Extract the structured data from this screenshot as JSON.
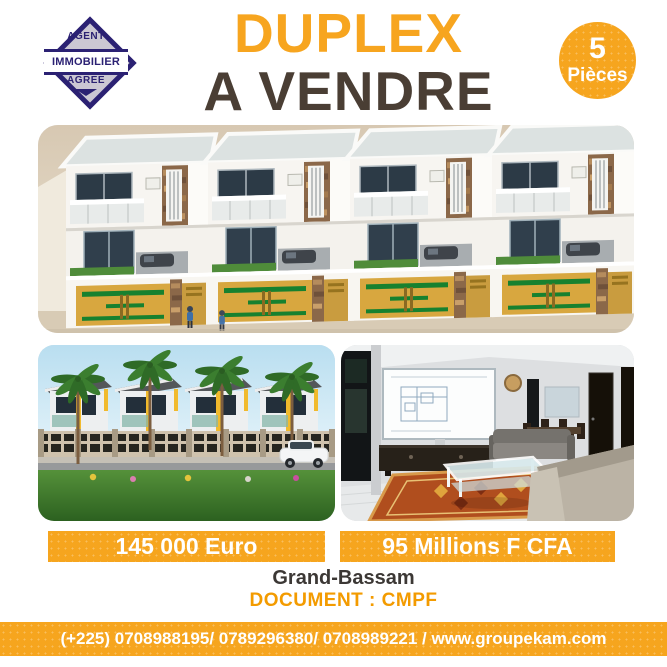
{
  "badge": {
    "top": "AGENT",
    "middle": "IMMOBILIER",
    "bottom": "AGREE"
  },
  "title": {
    "line1": "DUPLEX",
    "line2": "A VENDRE"
  },
  "rooms": {
    "count": "5",
    "label": "Pièces"
  },
  "images": {
    "main": "aerial-3d-render-four-attached-duplexes",
    "exterior": "street-view-render-duplex-row-palm-trees",
    "interior": "living-room-interior-render"
  },
  "prices": {
    "euro": "145 000 Euro",
    "cfa": "95 Millions F CFA"
  },
  "details": {
    "location": "Grand-Bassam",
    "document": "DOCUMENT : CMPF"
  },
  "footer": {
    "contact": "(+225) 0708988195/ 0789296380/ 0708989221 / www.groupekam.com"
  },
  "colors": {
    "accent_yellow": "#f6a51e",
    "title_yellow": "#f7a51f",
    "title_dark": "#4a3e34",
    "badge_navy": "#2b2173",
    "document_orange": "#f39b00",
    "text_dark": "#3c3835"
  }
}
